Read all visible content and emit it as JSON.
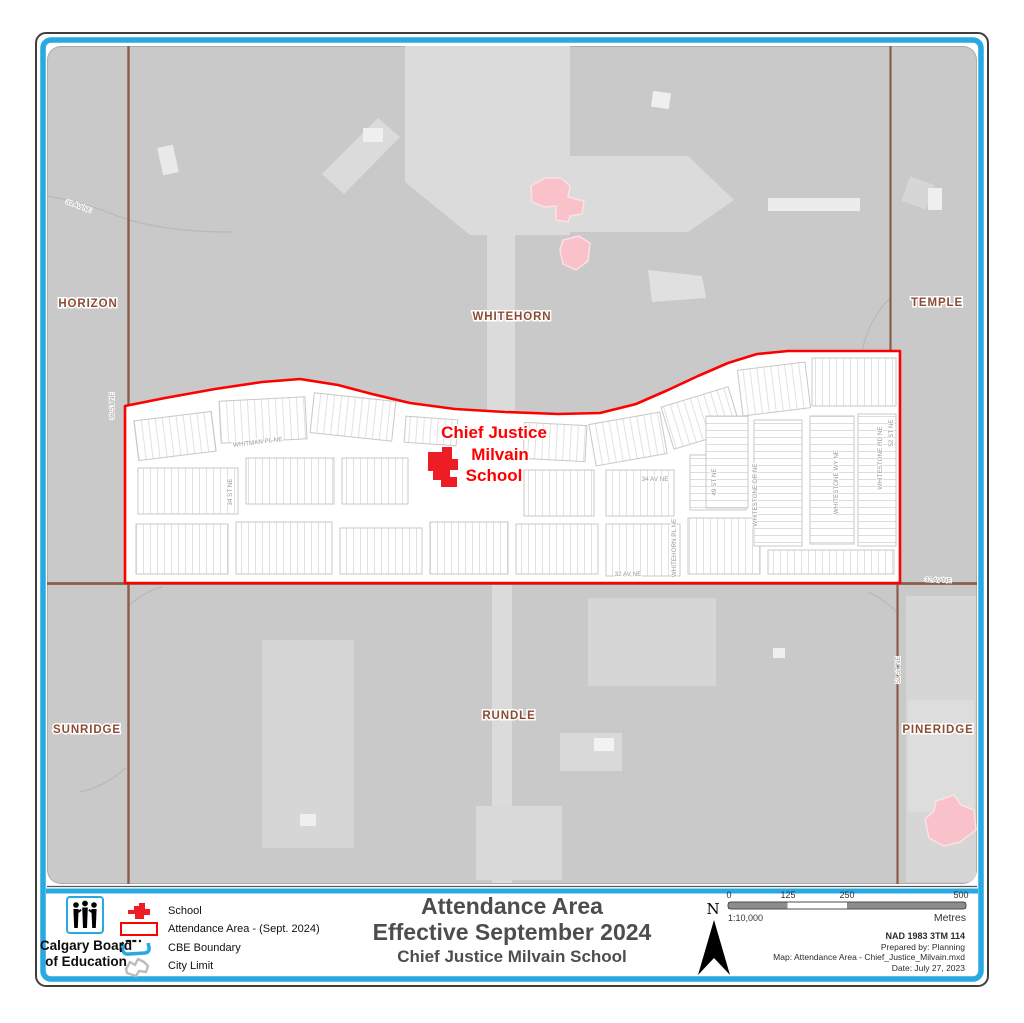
{
  "colors": {
    "cbe_blue": "#29A9E1",
    "frame_black": "#3F3F3F",
    "boundary_red": "#FE0000",
    "school_red": "#EE1C25",
    "other_school_pink": "#F9C2CB",
    "neighbourhood_brown": "#8C4B33",
    "map_gray": "#C9C9C9",
    "light_gray": "#DBDBDB",
    "road_brown": "#8A5C49",
    "title_gray": "#4D4D4F"
  },
  "map": {
    "neighbourhood_labels": [
      "HORIZON",
      "WHITEHORN",
      "TEMPLE",
      "SUNRIDGE",
      "RUNDLE",
      "PINERIDGE"
    ],
    "school_label_lines": [
      "Chief Justice",
      "Milvain",
      "School"
    ],
    "street_labels": {
      "av_39": "39 AV NE",
      "st_36": "36 ST NE",
      "st_34": "34 ST NE",
      "whitman_pl": "WHITMAN PL NE",
      "av_34": "34 AV NE",
      "st_49": "49 ST NE",
      "whitehorn_pl": "WHITEHORN PL NE",
      "whitestone_dr": "WHITESTONE DR NE",
      "whitestone_wy": "WHITESTONE WY NE",
      "whitestone_rd": "WHITESTONE RD NE",
      "st_52_north": "52 ST NE",
      "st_52_south": "52 ST NE",
      "av_32_mid": "32 AV NE",
      "av_32_right": "32 AV NE"
    }
  },
  "legend": {
    "logo_lines": [
      "Calgary Board",
      "of Education"
    ],
    "items": [
      {
        "label": "School"
      },
      {
        "label": "Attendance Area - (Sept. 2024)"
      },
      {
        "label": "CBE Boundary"
      },
      {
        "label": "City Limit"
      }
    ]
  },
  "title": {
    "line1": "Attendance Area",
    "line2": "Effective September 2024",
    "line3": "Chief Justice Milvain School"
  },
  "north": {
    "label": "N"
  },
  "scalebar": {
    "ticks": [
      "0",
      "125",
      "250",
      "500"
    ],
    "ratio": "1:10,000",
    "units": "Metres"
  },
  "map_info": {
    "line1": "NAD 1983 3TM 114",
    "line2": "Prepared by: Planning",
    "line3": "Map: Attendance Area - Chief_Justice_Milvain.mxd",
    "line4": "Date: July 27, 2023"
  }
}
